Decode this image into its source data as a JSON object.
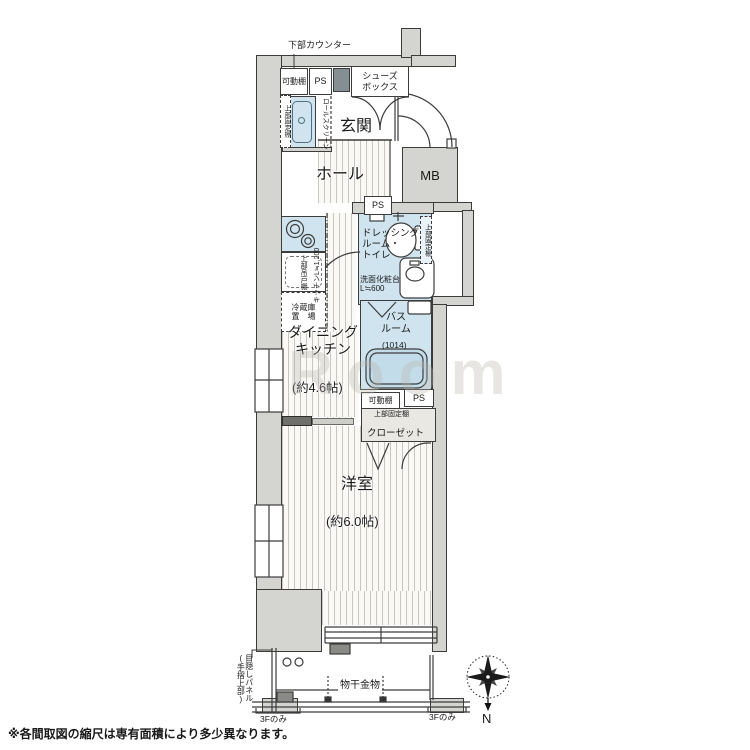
{
  "colors": {
    "wall_fill": "#d4d4d0",
    "fixture_blue": "#cfe4ef",
    "line": "#3c3c3c"
  },
  "plan": {
    "rooms": {
      "genkan": "玄関",
      "hall": "ホール",
      "dk": "ダイニング\nキッチン",
      "dk_size": "(約4.6帖)",
      "dressing": "ドレッシング\nルーム・\nトイレ",
      "bath": "バス\nルーム",
      "bath_size": "(1014)",
      "western_room": "洋室",
      "western_room_size": "(約6.0帖)"
    },
    "annotations": {
      "counter_below": "下部カウンター",
      "movable_shelf_entry": "可動棚",
      "ps_entry": "PS",
      "shoes_box": "シューズ\nボックス",
      "upper_fixed_shelf_entry": "上部固定棚",
      "waterproof_pan": "防水\nパン",
      "roll_screen": "ロールスクリーン",
      "mb": "MB",
      "ps_hall": "PS",
      "kitchen_length": "キッチンL≒1,200",
      "upper_hanging_cupboard": "上部吊戸棚",
      "fridge_space": "冷蔵庫\n置　場",
      "upper_fixed_shelf_dressing": "上部固定棚",
      "vanity": "洗面化粧台\nL≒600",
      "movable_shelf_bath": "可動棚",
      "ps_bath": "PS",
      "upper_fixed_shelf_closet": "上部固定棚",
      "closet": "クローゼット",
      "laundry_pole": "物干金物",
      "privacy_panel": "目隠しパネル\n(手摺上部)",
      "third_floor_only_left": "3Fのみ",
      "third_floor_only_right": "3Fのみ"
    },
    "compass": {
      "north": "N"
    }
  },
  "watermark": "Room",
  "footer": {
    "note": "※各間取図の縮尺は専有面積により多少異なります。"
  }
}
